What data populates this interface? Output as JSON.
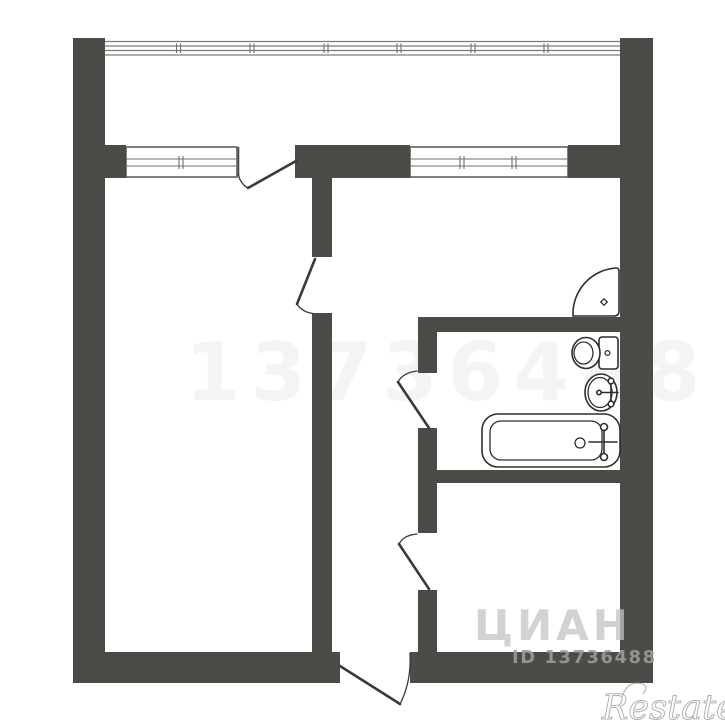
{
  "plan": {
    "type": "apartment-floor-plan",
    "windows": [
      "balcony-glazing",
      "window-left",
      "window-right"
    ],
    "doors": [
      "balcony-door",
      "room-door",
      "bathroom-door",
      "kitchen-door",
      "entry-door"
    ],
    "fixtures": [
      "corner-shower",
      "toilet",
      "sink",
      "bathtub"
    ]
  },
  "watermarks": {
    "faint_center": "13736488",
    "portal": "ЦИАН",
    "listing_id": "ID 13736488",
    "brand": "Restate"
  },
  "colors": {
    "wall": "#4b4b48",
    "fixture_line": "#2e2e2c",
    "watermark_gray": "#9b9b99",
    "portal_gray": "#c4c4c2",
    "brand_outline": "#b2b2b0",
    "background": "#ffffff"
  }
}
